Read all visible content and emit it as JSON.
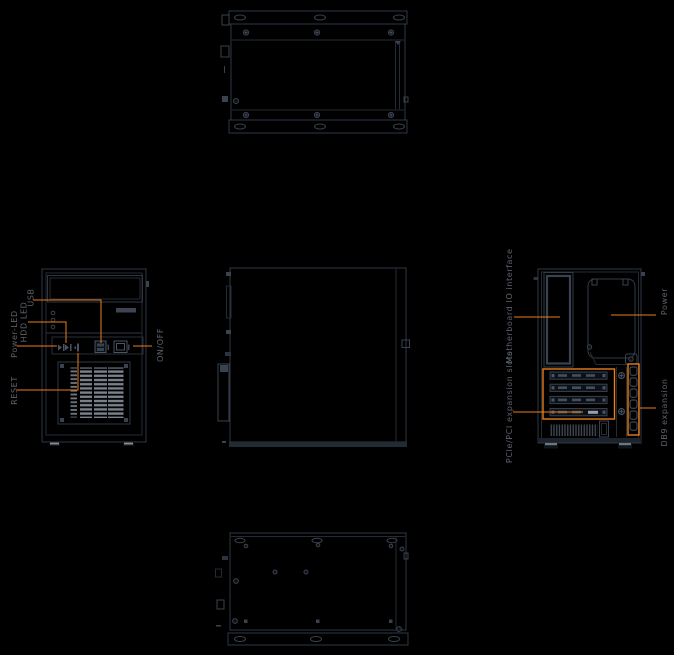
{
  "colors": {
    "background": "#000000",
    "outline": "#2e3743",
    "outline_soft": "#232b35",
    "detail": "#39424f",
    "detail_bright": "#4a5464",
    "slat": "#7a818b",
    "slat_dim": "#434c58",
    "fill_dark": "#0c1117",
    "accent": "#e87d1a",
    "label_text": "#5e636b"
  },
  "annotations": {
    "front": [
      {
        "id": "usb",
        "label": "USB"
      },
      {
        "id": "hdd-led",
        "label": "HDD LED"
      },
      {
        "id": "power-led",
        "label": "Power-LED"
      },
      {
        "id": "reset",
        "label": "RESET"
      },
      {
        "id": "on-off",
        "label": "ON/OFF"
      }
    ],
    "rear": [
      {
        "id": "motherboard-io",
        "label": "Motherboard IO interface"
      },
      {
        "id": "power",
        "label": "Power"
      },
      {
        "id": "pcie-pci-slots",
        "label": "PCIe/PCI expansion slots"
      },
      {
        "id": "db9-expansion",
        "label": "DB9 expansion"
      }
    ]
  }
}
